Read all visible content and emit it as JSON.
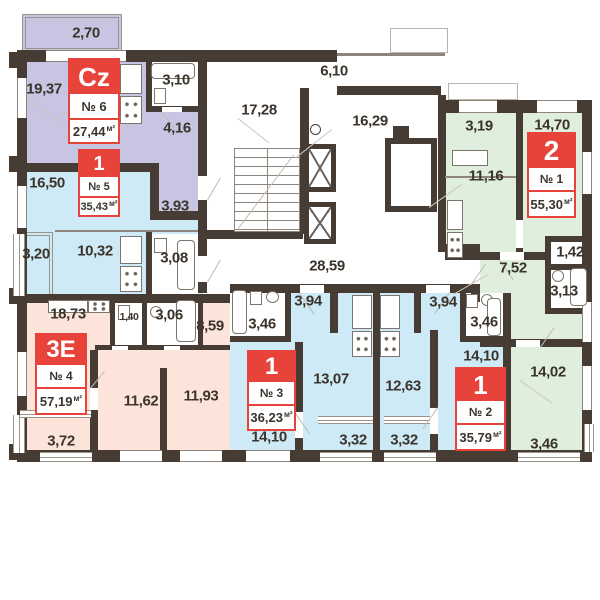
{
  "colors": {
    "wall": "#473c33",
    "apartment_cz": "#c8c5e3",
    "apartment_1room": "#ceeaf7",
    "apartment_3e": "#fce4da",
    "apartment_2room": "#dfeedd",
    "badge_red": "#e8433b",
    "label_text": "#3b342c"
  },
  "apartments": [
    {
      "type_label": "Cz",
      "number": "№ 6",
      "area": "27,44",
      "unit": "м²",
      "rooms": {
        "balcony": "2,70",
        "living": "19,37",
        "bathroom": "3,10",
        "hallway": "4,16"
      }
    },
    {
      "type_label": "1",
      "number": "№ 5",
      "area": "35,43",
      "unit": "м²",
      "rooms": {
        "living": "16,50",
        "hallway": "3,93",
        "balcony": "3,20",
        "kitchen": "10,32",
        "bathroom": "3,08"
      }
    },
    {
      "type_label": "3E",
      "number": "№ 4",
      "area": "57,19",
      "unit": "м²",
      "rooms": {
        "kitchen_living": "18,73",
        "wc": "1,40",
        "bathroom": "3,06",
        "hallway": "8,59",
        "bedroom_1": "11,62",
        "bedroom_2": "11,93",
        "balcony": "3,72"
      }
    },
    {
      "type_label": "1",
      "number": "№ 3",
      "area": "36,23",
      "unit": "м²",
      "rooms": {
        "hallway": "3,94",
        "bathroom": "3,46",
        "kitchen_living": "13,07",
        "bedroom": "14,10",
        "balcony": "3,32"
      }
    },
    {
      "type_label": "1",
      "number": "№ 2",
      "area": "35,79",
      "unit": "м²",
      "rooms": {
        "hallway": "3,94",
        "bathroom": "3,46",
        "kitchen": "12,63",
        "bedroom": "14,10",
        "balcony": "3,32"
      }
    },
    {
      "type_label": "2",
      "number": "№ 1",
      "area": "55,30",
      "unit": "м²",
      "rooms": {
        "hallway": "3,19",
        "kitchen": "11,16",
        "bedroom_1": "14,70",
        "hall": "7,52",
        "storage": "1,42",
        "bathroom": "3,13",
        "bedroom_2": "14,02",
        "balcony": "3,46"
      }
    }
  ],
  "common_areas": {
    "stairwell": "17,28",
    "entrance_hall": "6,10",
    "lift_lobby": "16,29",
    "corridor": "28,59"
  }
}
